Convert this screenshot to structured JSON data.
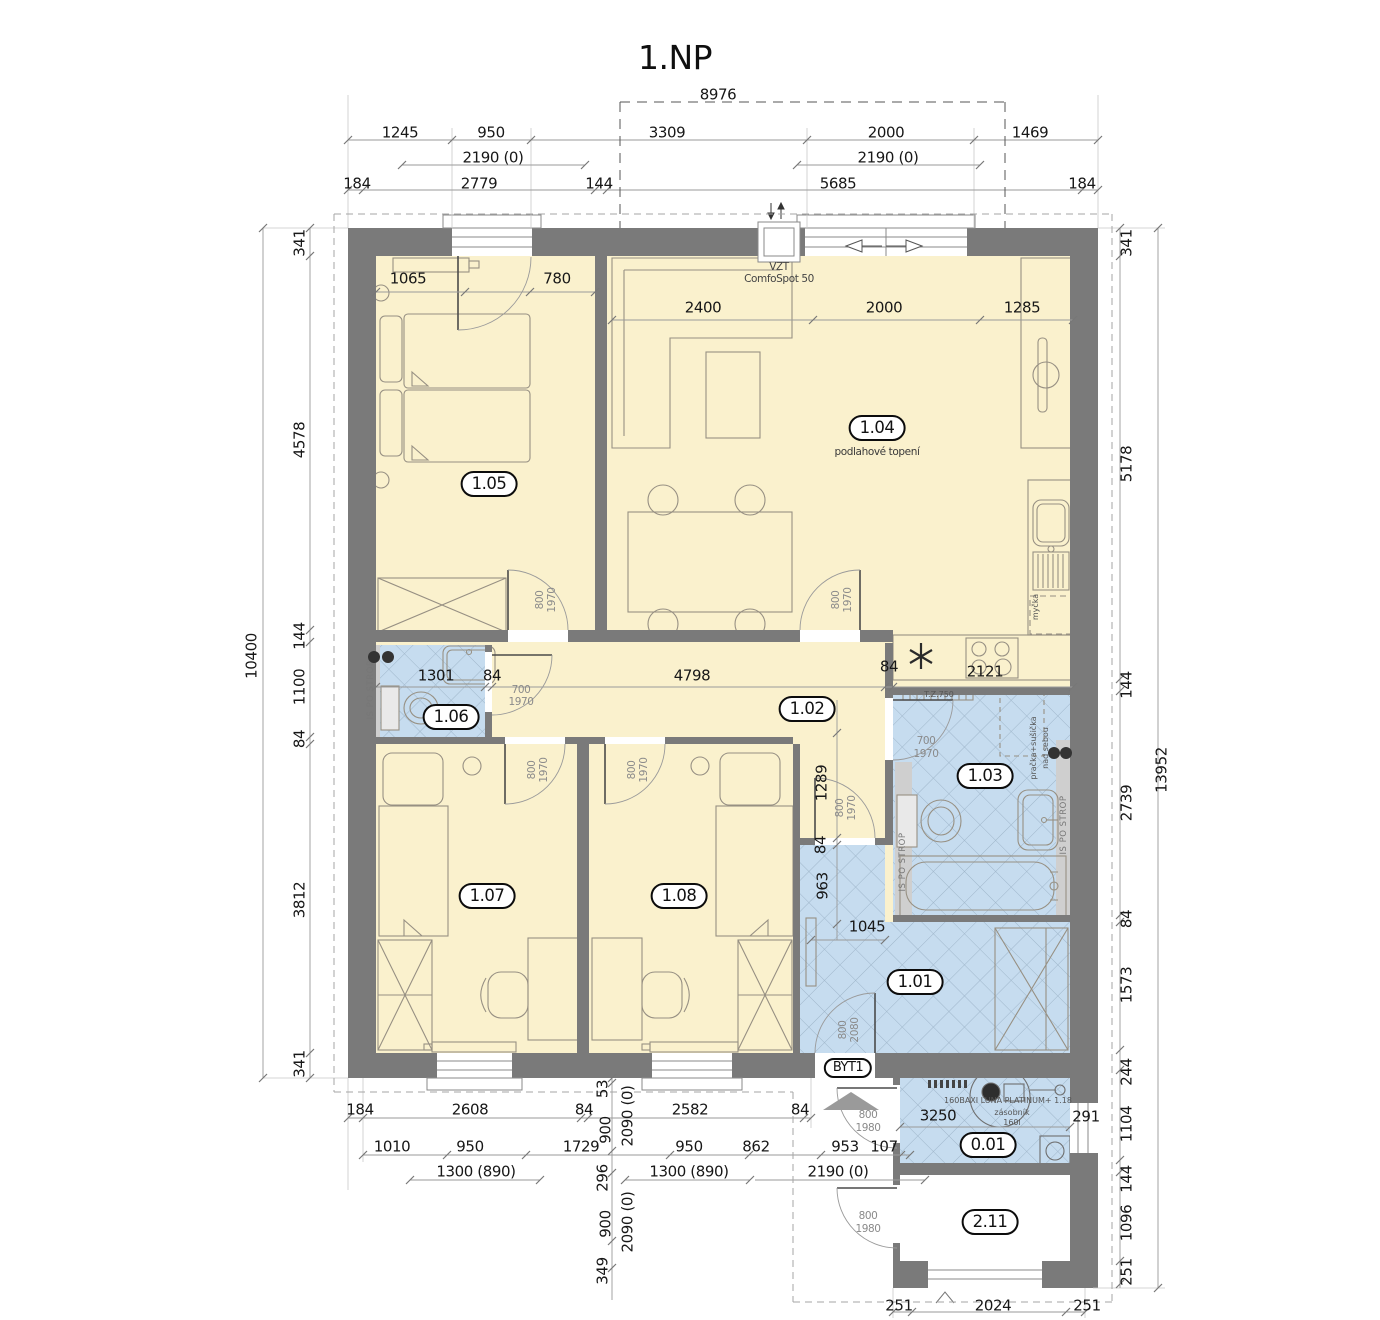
{
  "title": "1.NP",
  "colors": {
    "wall": "#7a7a7a",
    "room_yellow": "#faf1cd",
    "room_blue": "#c6dcef",
    "hatch_line": "#9fb6ca",
    "dim_text": "#171717",
    "accent_gray": "#cfcfcf"
  },
  "rooms": {
    "r101": "1.01",
    "r102": "1.02",
    "r103": "1.03",
    "r104": "1.04",
    "r105": "1.05",
    "r106": "1.06",
    "r107": "1.07",
    "r108": "1.08",
    "r001": "0.01",
    "r211": "2.11",
    "byt": "BYT1",
    "note104": "podlahové topení"
  },
  "ann": {
    "vzt1": "VZT",
    "vzt2": "ComfoSpot 50",
    "strop": "IS PO STROP",
    "pracka1": "pračka+sušička",
    "pracka2": "nad sebou",
    "tz": "T.Z.750",
    "mycka": "myčka",
    "boiler": "160BAXI LUNA PLATINUM+ 1.18",
    "zas1": "zásobník",
    "zas2": "160l"
  },
  "dims": {
    "top1": "8976",
    "top2": [
      "1245",
      "950",
      "3309",
      "2000",
      "1469"
    ],
    "top3": [
      "2190 (0)",
      "2190 (0)"
    ],
    "top4": [
      "184",
      "2779",
      "144",
      "5685",
      "184"
    ],
    "left": [
      "341",
      "4578",
      "144",
      "1100",
      "84",
      "3812",
      "341"
    ],
    "left_total": "10400",
    "right": [
      "341",
      "5178",
      "144",
      "2739",
      "84",
      "1573",
      "244",
      "1104",
      "144",
      "1096",
      "251"
    ],
    "right_total": "13952",
    "bottom1": [
      "184",
      "2608",
      "84",
      "2582",
      "84"
    ],
    "bottom2": [
      "1010",
      "950",
      "1729",
      "950",
      "862",
      "953",
      "107"
    ],
    "bottom3": [
      "1300 (890)",
      "1300 (890)",
      "2190 (0)"
    ],
    "bottomv": [
      "53",
      "900",
      "296",
      "900",
      "349"
    ],
    "bottomv2": [
      "2090 (0)",
      "2090 (0)"
    ],
    "bottomr": [
      "251",
      "2024",
      "251"
    ],
    "room": {
      "a1065": "1065",
      "a780": "780",
      "a2400": "2400",
      "a2000": "2000",
      "a1285": "1285",
      "a1301": "1301",
      "a84": "84",
      "a4798": "4798",
      "a2121": "2121",
      "a1289": "1289",
      "a963": "963",
      "a1045": "1045",
      "a3250": "3250",
      "a291": "291"
    },
    "doors": {
      "d700": "700",
      "d800": "800",
      "d1970": "1970",
      "d1980": "1980",
      "d2080": "2080"
    }
  }
}
